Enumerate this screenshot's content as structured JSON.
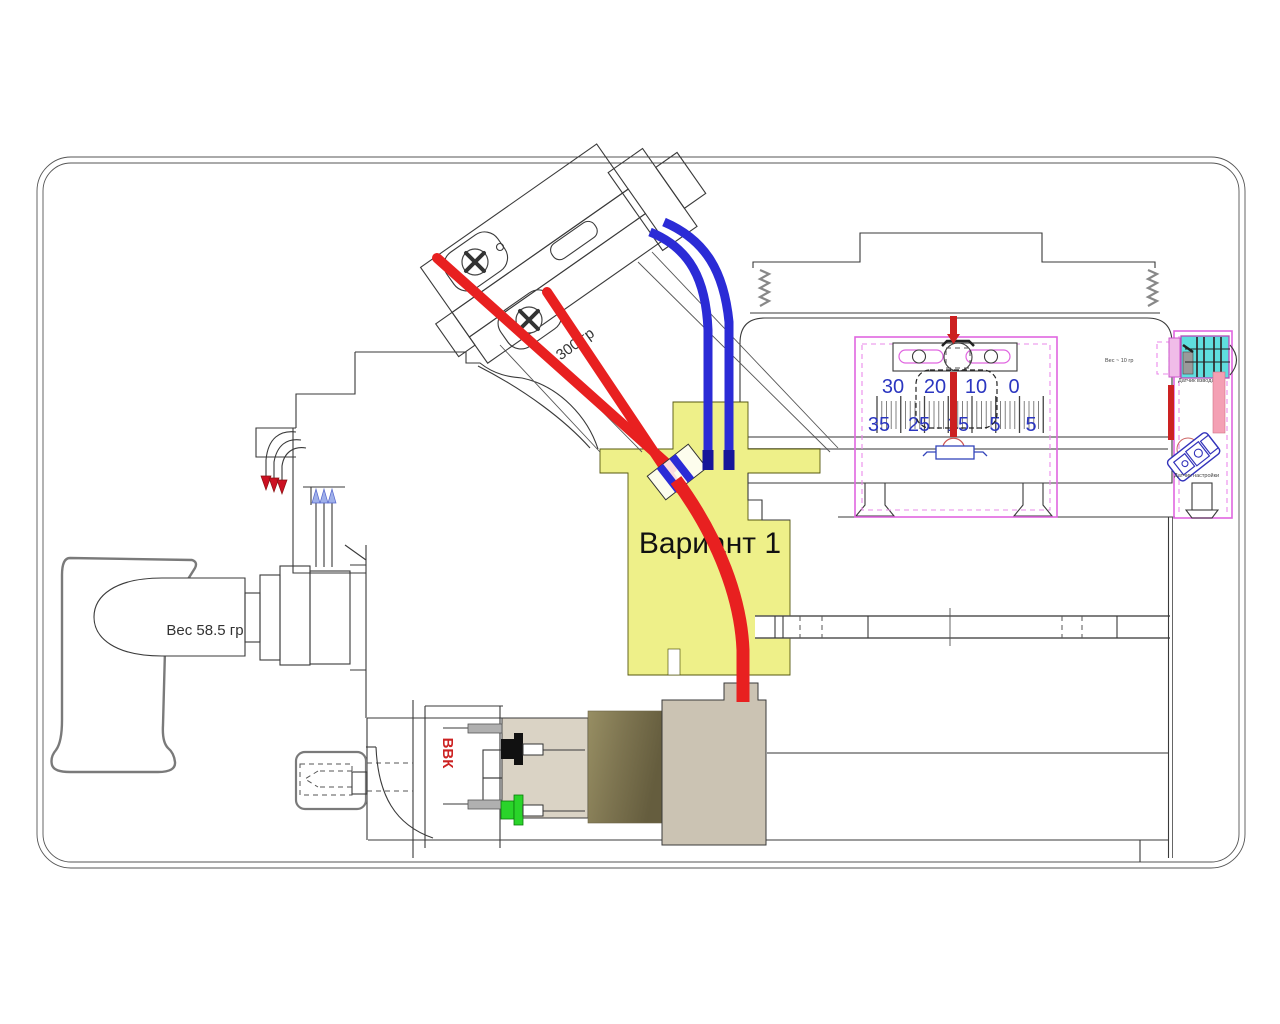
{
  "annotations": {
    "variant": "Вариант 1",
    "handle_weight": "Вес 58.5 гр",
    "spring_force": "300 гр",
    "bbk": "ВВК",
    "right_box_weight": "Вес ~ 10 гр",
    "sensor_top": "Датчик взвода",
    "sensor_bottom": "Датчик настройки"
  },
  "scale": {
    "top_row": [
      "30",
      "20",
      "10",
      "0"
    ],
    "bottom_row": [
      "35",
      "25",
      "15",
      "5",
      "5"
    ]
  },
  "colors": {
    "highlight_yellow": "#eef089",
    "wire_red": "#e82020",
    "wire_blue": "#2b2bd6",
    "wire_blue_dark": "#16169a",
    "magenta": "#e066e0",
    "cyan_block": "#5fdede",
    "strip_red": "#cc2222",
    "strip_pink": "#f4a0b4",
    "block_beige": "#dad3c5",
    "block_olive": "#8a815a",
    "block_taupe": "#cbc3b3",
    "plug_green": "#2ad42a",
    "plug_black": "#111111",
    "scale_numbers_blue": "#2b36c0",
    "label_red": "#cc2222"
  }
}
